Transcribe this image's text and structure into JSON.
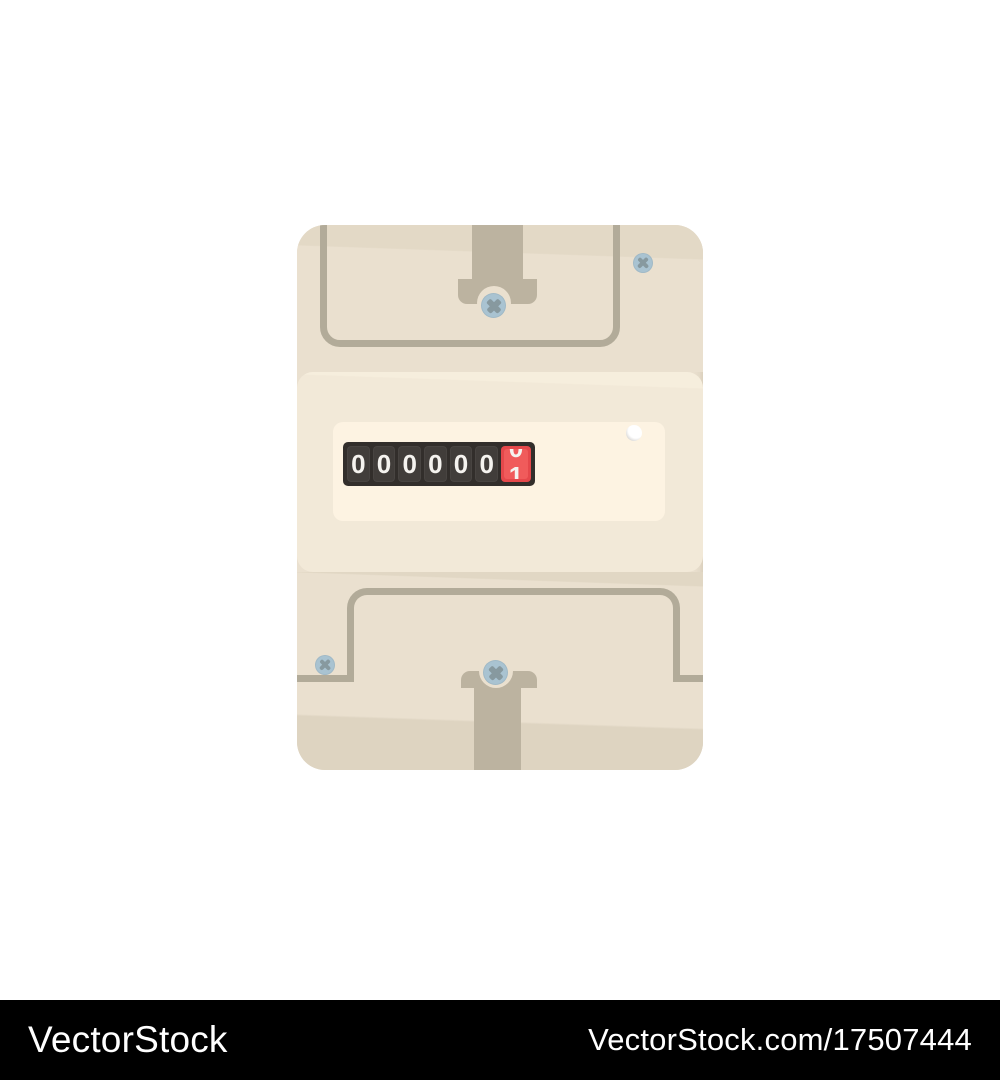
{
  "watermark": {
    "brand": "VectorStock",
    "url": "VectorStock.com/17507444"
  },
  "meter": {
    "counter": {
      "digits": [
        "0",
        "0",
        "0",
        "0",
        "0",
        "0"
      ],
      "rolling_digit": {
        "from": "0",
        "to": "1"
      }
    },
    "icons": {
      "screws": "phillips-screw",
      "indicator": "indicator-dot"
    }
  },
  "theme": {
    "pageBg": "#ffffff",
    "body": "#eae0cf",
    "bodyShade": "#e3d9c6",
    "band": "#f2e9d8",
    "bandHi": "#f6eedd",
    "panel": "#fdf3e2",
    "outline": "#b2ab99",
    "tab": "#bcb3a0",
    "lowerShade": "#e1d7c4",
    "lowerBottom": "#ded4c1",
    "counterHousing": "#322e2b",
    "cell": "#413d3a",
    "digit": "#f5f3ef",
    "rollBg": "#e5484b",
    "rollFace": "#f05b5b",
    "screw": "#a9c3d1",
    "screwCross": "#87999f",
    "dotShade": "#cbc9c7",
    "bar": "#000000",
    "barText": "#ffffff"
  }
}
